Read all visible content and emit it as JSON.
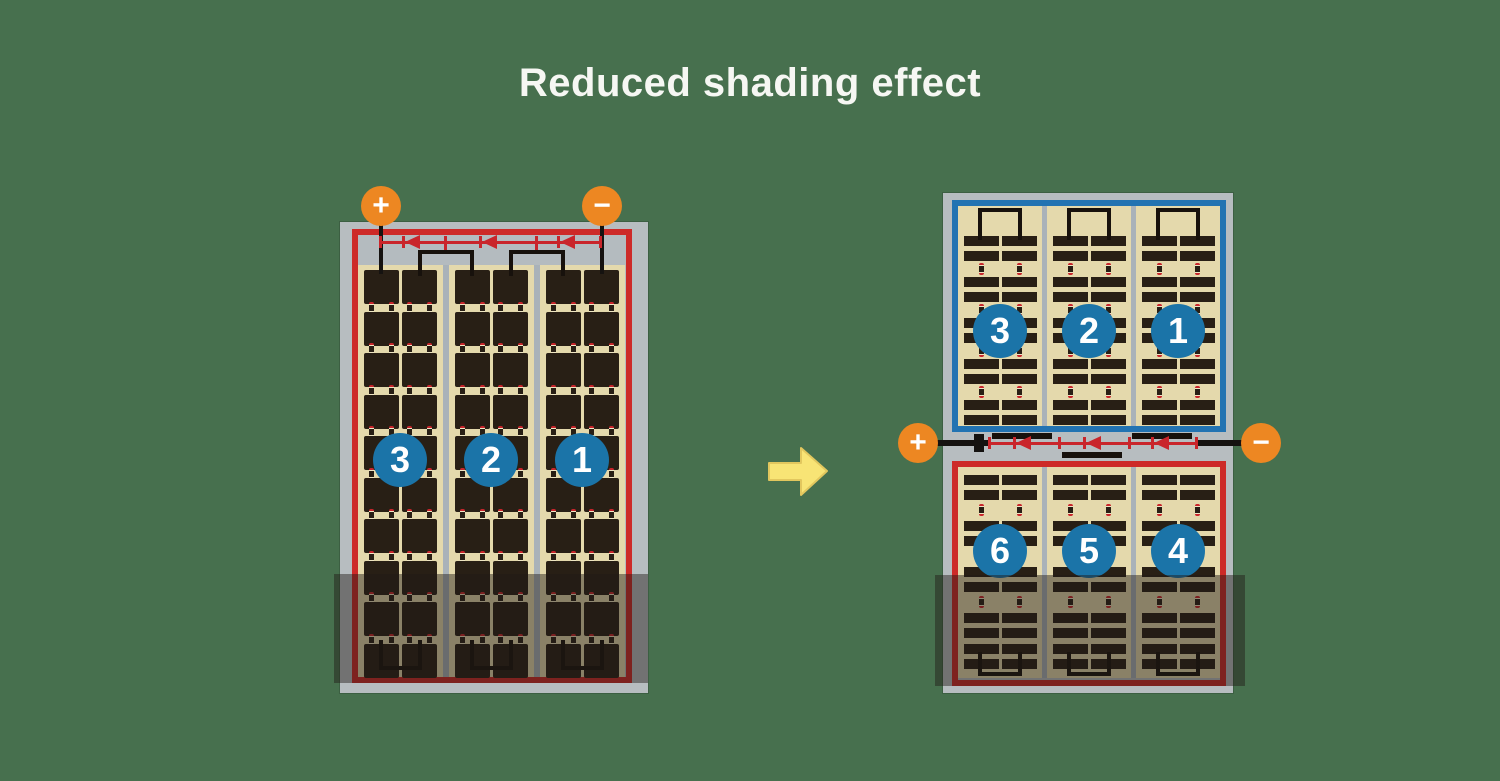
{
  "title": "Reduced shading effect",
  "colors": {
    "background": "#47704e",
    "title_text": "#f6f7f3",
    "panel_frame": "#b7bdc0",
    "panel_strip": "#b4bbbf",
    "section_divider": "#a9b2b9",
    "cell_field": "#e4d9ac",
    "cell": "#281f15",
    "busbar_black": "#17110c",
    "wire_black": "#151210",
    "red_border": "#cd2a28",
    "diode_red": "#c9252b",
    "blue_border": "#2273b2",
    "number_circle": "#1b74a8",
    "circle_text": "#ffffff",
    "terminal_orange": "#ed8722",
    "terminal_text": "#ffffff",
    "arrow_yellow": "#f8e475",
    "arrow_outline": "#e2c75e",
    "shade": "rgba(32,27,21,0.46)",
    "interconnect_cream": "#efe6c4"
  },
  "left_panel": {
    "terminals": {
      "positive": "+",
      "negative": "−"
    },
    "sections": [
      {
        "label": "3"
      },
      {
        "label": "2"
      },
      {
        "label": "1"
      }
    ],
    "diode_count": 3,
    "shaded_area": "bottom"
  },
  "arrow": {
    "direction": "right"
  },
  "right_panel": {
    "terminals": {
      "positive": "+",
      "negative": "−"
    },
    "top_sections": [
      {
        "label": "3"
      },
      {
        "label": "2"
      },
      {
        "label": "1"
      }
    ],
    "bottom_sections": [
      {
        "label": "6"
      },
      {
        "label": "5"
      },
      {
        "label": "4"
      }
    ],
    "diode_count": 3,
    "shaded_area": "bottom"
  }
}
